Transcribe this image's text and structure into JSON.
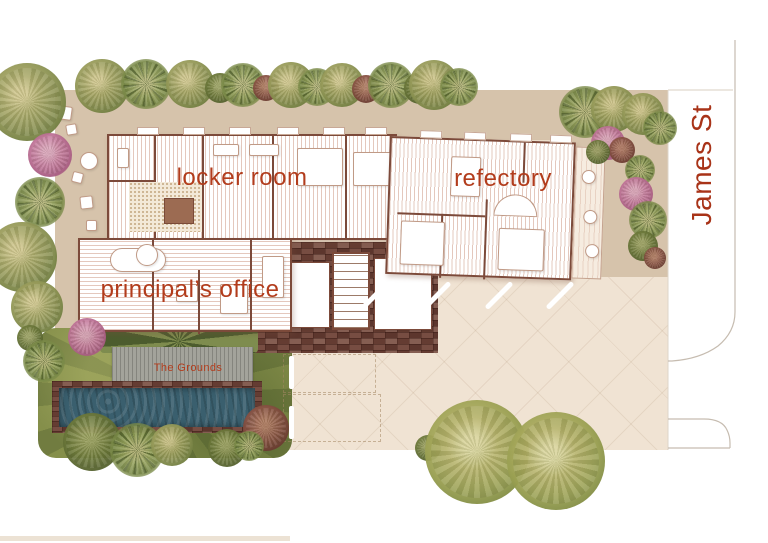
{
  "labels": {
    "locker_room": "locker room",
    "refectory": "refectory",
    "principals_office": "principal’s office",
    "grounds": "The Grounds",
    "street": "James St"
  },
  "colors": {
    "label": "#b23c1c",
    "street_label": "#a83318",
    "site_beige": "#eee0cd",
    "terrace_tan": "#d6c3ab",
    "driveway": "#f0e3d3",
    "brick": "#6e4338",
    "deck": "#a3a39b",
    "pool": "#3a5f6e",
    "lawn": "#7d8747",
    "wall": "#7c4a3a",
    "curb": "#c6bcb0"
  },
  "scene": {
    "trees": [
      {
        "x": 102,
        "y": 86,
        "r": 27,
        "k": "olive"
      },
      {
        "x": 146,
        "y": 84,
        "r": 25,
        "k": "palm"
      },
      {
        "x": 190,
        "y": 84,
        "r": 24,
        "k": "olive"
      },
      {
        "x": 220,
        "y": 88,
        "r": 15,
        "k": "dark"
      },
      {
        "x": 243,
        "y": 85,
        "r": 22,
        "k": "palm"
      },
      {
        "x": 266,
        "y": 88,
        "r": 13,
        "k": "maroon"
      },
      {
        "x": 291,
        "y": 85,
        "r": 23,
        "k": "olive"
      },
      {
        "x": 317,
        "y": 87,
        "r": 19,
        "k": "palm"
      },
      {
        "x": 342,
        "y": 85,
        "r": 22,
        "k": "olive"
      },
      {
        "x": 366,
        "y": 89,
        "r": 14,
        "k": "maroon"
      },
      {
        "x": 391,
        "y": 85,
        "r": 23,
        "k": "palm"
      },
      {
        "x": 420,
        "y": 88,
        "r": 16,
        "k": "dark"
      },
      {
        "x": 434,
        "y": 85,
        "r": 25,
        "k": "olive"
      },
      {
        "x": 459,
        "y": 87,
        "r": 19,
        "k": "palm"
      },
      {
        "x": 585,
        "y": 112,
        "r": 26,
        "k": "palm"
      },
      {
        "x": 614,
        "y": 109,
        "r": 23,
        "k": "olive"
      },
      {
        "x": 643,
        "y": 114,
        "r": 21,
        "k": "olive"
      },
      {
        "x": 660,
        "y": 128,
        "r": 17,
        "k": "palm"
      },
      {
        "x": 608,
        "y": 143,
        "r": 17,
        "k": "pink"
      },
      {
        "x": 622,
        "y": 150,
        "r": 13,
        "k": "maroon"
      },
      {
        "x": 598,
        "y": 152,
        "r": 12,
        "k": "dark"
      },
      {
        "x": 640,
        "y": 170,
        "r": 15,
        "k": "palm"
      },
      {
        "x": 636,
        "y": 194,
        "r": 17,
        "k": "pink"
      },
      {
        "x": 648,
        "y": 220,
        "r": 19,
        "k": "palm"
      },
      {
        "x": 643,
        "y": 246,
        "r": 15,
        "k": "dark"
      },
      {
        "x": 655,
        "y": 258,
        "r": 11,
        "k": "maroon"
      },
      {
        "x": 27,
        "y": 102,
        "r": 39,
        "k": "olive"
      },
      {
        "x": 50,
        "y": 155,
        "r": 22,
        "k": "pink"
      },
      {
        "x": 40,
        "y": 202,
        "r": 25,
        "k": "palm"
      },
      {
        "x": 22,
        "y": 257,
        "r": 35,
        "k": "olive"
      },
      {
        "x": 37,
        "y": 307,
        "r": 26,
        "k": "olive"
      },
      {
        "x": 30,
        "y": 338,
        "r": 13,
        "k": "dark"
      },
      {
        "x": 44,
        "y": 361,
        "r": 21,
        "k": "palm"
      },
      {
        "x": 87,
        "y": 337,
        "r": 19,
        "k": "pink"
      },
      {
        "x": 92,
        "y": 442,
        "r": 29,
        "k": "dark"
      },
      {
        "x": 137,
        "y": 450,
        "r": 27,
        "k": "palm"
      },
      {
        "x": 172,
        "y": 445,
        "r": 21,
        "k": "olive"
      },
      {
        "x": 227,
        "y": 448,
        "r": 19,
        "k": "dark"
      },
      {
        "x": 266,
        "y": 428,
        "r": 23,
        "k": "maroon"
      },
      {
        "x": 249,
        "y": 446,
        "r": 15,
        "k": "palm"
      },
      {
        "x": 428,
        "y": 448,
        "r": 13,
        "k": "dark"
      },
      {
        "x": 477,
        "y": 452,
        "r": 52,
        "k": "olive2"
      },
      {
        "x": 556,
        "y": 461,
        "r": 49,
        "k": "olive2"
      }
    ],
    "parking": {
      "stripes": [
        {
          "x": 375,
          "y": 295
        },
        {
          "x": 437,
          "y": 295
        },
        {
          "x": 499,
          "y": 295
        },
        {
          "x": 560,
          "y": 295
        }
      ],
      "lane_dashes": [
        {
          "x": 289,
          "y": 356,
          "h": 33
        },
        {
          "x": 289,
          "y": 406,
          "h": 33
        }
      ],
      "bays": [
        {
          "x": 283,
          "y": 354,
          "w": 93,
          "h": 39
        },
        {
          "x": 283,
          "y": 394,
          "w": 98,
          "h": 48
        }
      ]
    }
  }
}
